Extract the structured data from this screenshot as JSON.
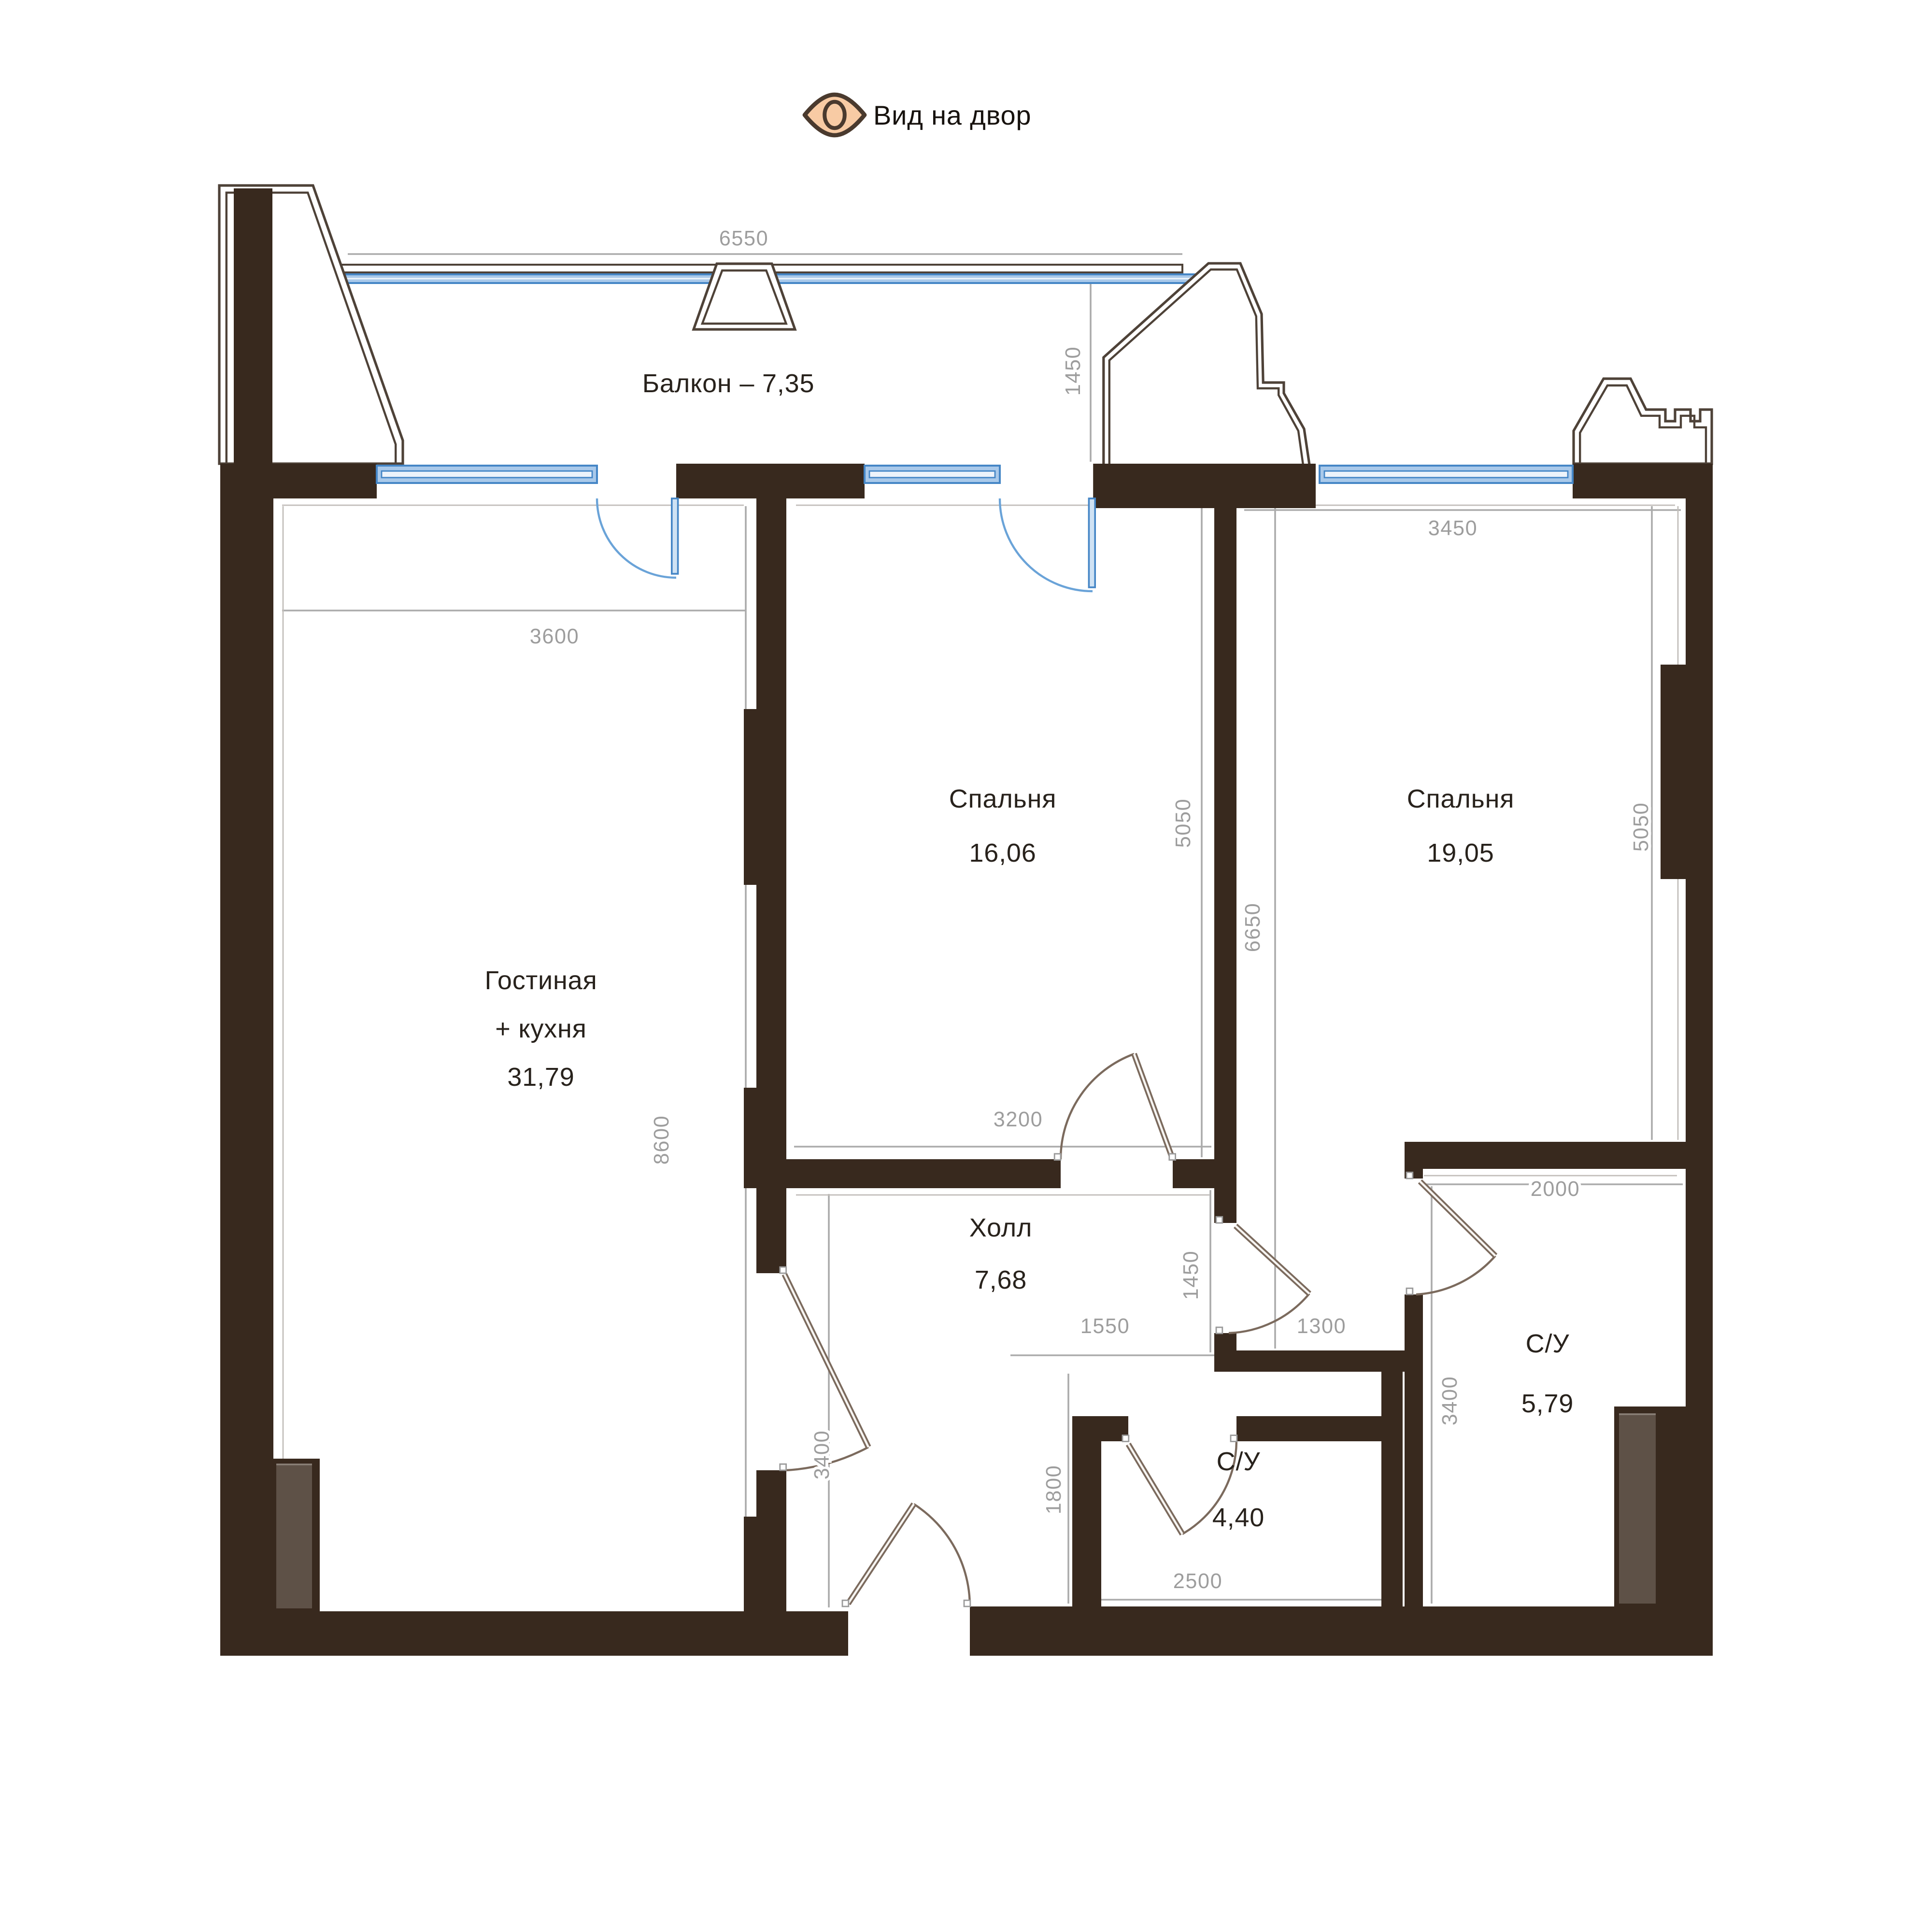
{
  "legend": {
    "label": "Вид на двор",
    "icon": "eye-icon"
  },
  "rooms": {
    "balcony": {
      "label": "Балкон – 7,35"
    },
    "living": {
      "line1": "Гостиная",
      "line2": "+ кухня",
      "area": "31,79"
    },
    "bedroom1": {
      "name": "Спальня",
      "area": "16,06"
    },
    "bedroom2": {
      "name": "Спальня",
      "area": "19,05"
    },
    "hall": {
      "name": "Холл",
      "area": "7,68"
    },
    "wc_main": {
      "name": "С/У",
      "area": "5,79"
    },
    "wc_guest": {
      "name": "С/У",
      "area": "4,40"
    }
  },
  "dimensions": {
    "balcony_width": "6550",
    "balcony_depth": "1450",
    "living_width": "3600",
    "living_depth": "8600",
    "bedroom1_width": "3200",
    "bedroom1_depth": "5050",
    "bedroom2_width": "3450",
    "bedroom2_depth": "5050",
    "bedrooms_total_depth": "6650",
    "hall_passage_depth": "1450",
    "hall_opening_width": "1550",
    "corridor_width": "1300",
    "hall_left_depth": "3400",
    "wc_main_width": "2000",
    "wc_main_depth": "3400",
    "wc_guest_depth": "1800",
    "wc_guest_width": "2500"
  },
  "colors": {
    "wall": "#38291e",
    "glazing_fill": "#a9c9ea",
    "glazing_stroke": "#4586c6",
    "door_arc": "#7b6a5d",
    "dim_text": "#9d9d9d",
    "shaft_fill": "#5e5147",
    "eye_fill": "#f8cba4"
  }
}
